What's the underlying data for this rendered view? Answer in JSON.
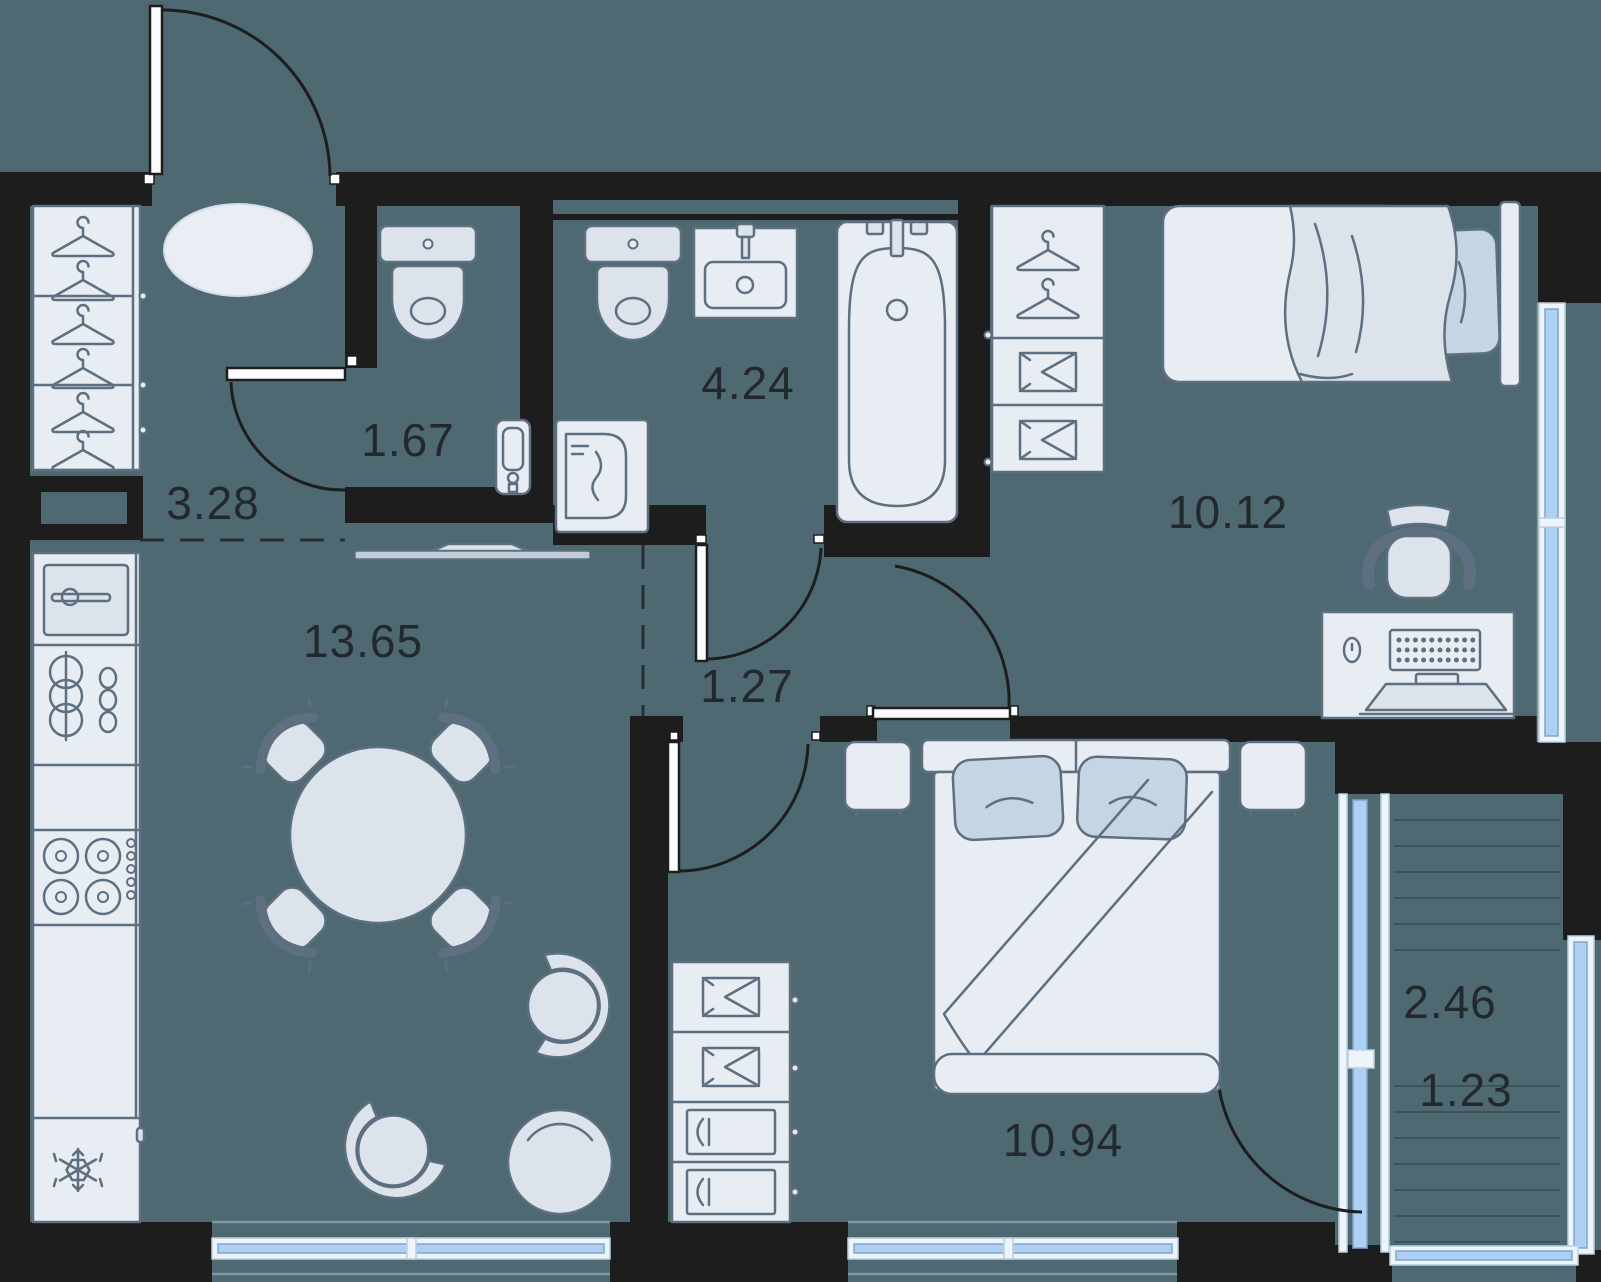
{
  "plan": {
    "colors": {
      "floor": "#4e6971",
      "wall": "#1d1d1e",
      "furn": "#dce3eb",
      "furnl": "#e8edf3",
      "pillow": "#c6d5e4",
      "stroke": "#5d6f80",
      "glass": "#aed0f2",
      "glassframe": "#eef4fb",
      "deck": "#3c5359",
      "thin": "#8097a0",
      "dashc": "#272e33",
      "label": "#23282e"
    },
    "rooms": [
      {
        "id": "hallway",
        "area": "3.28"
      },
      {
        "id": "wc",
        "area": "1.67"
      },
      {
        "id": "bathroom",
        "area": "4.24"
      },
      {
        "id": "bedroom-top",
        "area": "10.12"
      },
      {
        "id": "kitchen-living",
        "area": "13.65"
      },
      {
        "id": "corridor",
        "area": "1.27"
      },
      {
        "id": "bedroom-bottom",
        "area": "10.94"
      },
      {
        "id": "balcony",
        "area_total": "2.46",
        "area_counted": "1.23"
      }
    ]
  }
}
